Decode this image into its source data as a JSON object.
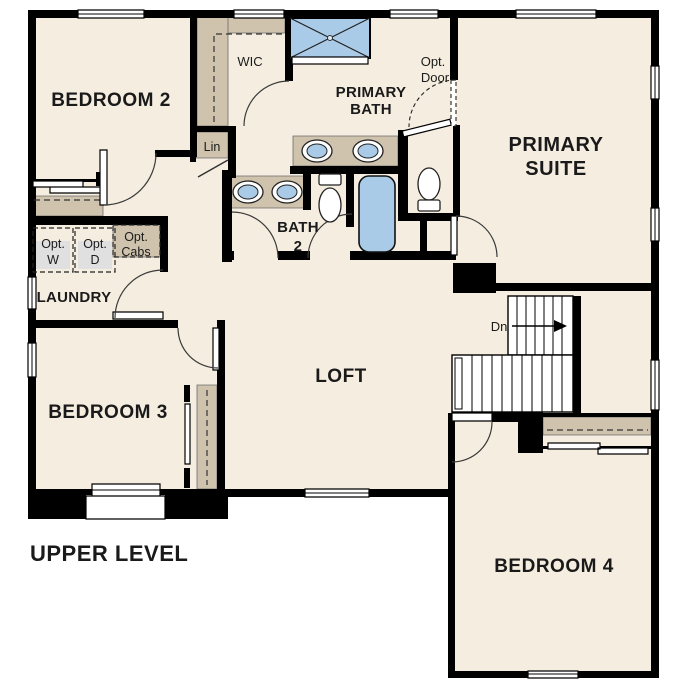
{
  "plan": {
    "title": "UPPER LEVEL",
    "rooms": {
      "bedroom2": "BEDROOM 2",
      "wic": "WIC",
      "primary_bath": [
        "PRIMARY",
        "BATH"
      ],
      "primary_suite": [
        "PRIMARY",
        "SUITE"
      ],
      "bath2": [
        "BATH",
        "2"
      ],
      "laundry": "LAUNDRY",
      "bedroom3": "BEDROOM 3",
      "loft": "LOFT",
      "bedroom4": "BEDROOM 4",
      "linen": "Lin"
    },
    "annotations": {
      "opt_door": [
        "Opt.",
        "Door"
      ],
      "opt_washer": [
        "Opt.",
        "W"
      ],
      "opt_dryer": [
        "Opt.",
        "D"
      ],
      "opt_cabs": [
        "Opt.",
        "Cabs"
      ],
      "stairs_down": "Dn"
    },
    "colors": {
      "background": "#ffffff",
      "floor": "#f5eee0",
      "wall": "#000000",
      "casework": "#cfc3ad",
      "fixture_blue": "#a9cbe7",
      "appliance": "#e0e0e0"
    },
    "fixtures": [
      "shower",
      "primary-double-vanity",
      "bath2-double-vanity",
      "primary-toilet",
      "bath2-toilet",
      "bathtub",
      "optional-washer",
      "optional-dryer",
      "stairs-down"
    ]
  }
}
